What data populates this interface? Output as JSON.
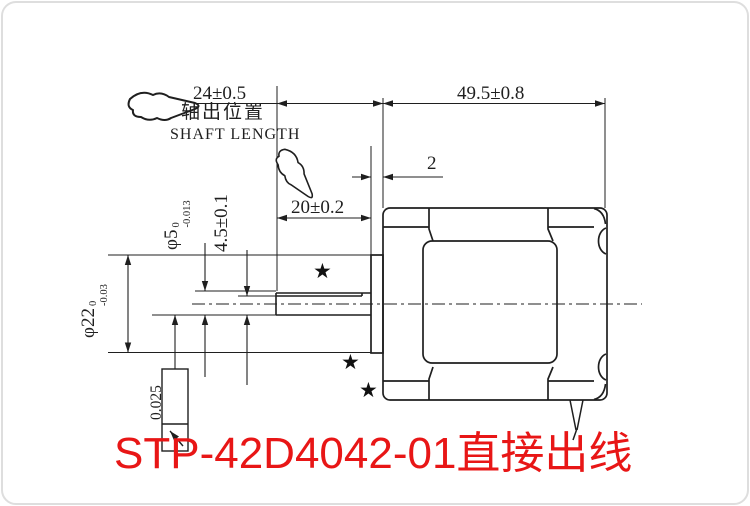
{
  "page": {
    "background": "#ffffff",
    "line_color": "#1f1f1f",
    "accent_red": "#e81616"
  },
  "drawing": {
    "labels": {
      "shaft_len_dim": "24±0.5",
      "shaft_pos_cn": "轴出位置",
      "shaft_pos_en": "SHAFT LENGTH",
      "body_len_dim": "49.5±0.8",
      "boss_protrusion_dim": "2",
      "flat_len_dim": "20±0.2",
      "shaft_dia_base": "φ5",
      "shaft_dia_tol_up": "0",
      "shaft_dia_tol_low": "-0.013",
      "flat_height_dim": "4.5±0.1",
      "boss_dia_base": "φ22",
      "boss_dia_tol_up": "0",
      "boss_dia_tol_low": "-0.03",
      "runout_tolerance": "0.025",
      "star_mark": "★"
    },
    "title": "STP-42D4042-01直接出线"
  }
}
